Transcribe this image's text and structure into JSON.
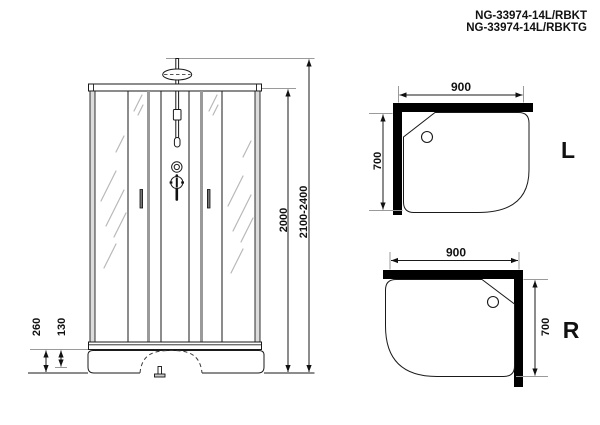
{
  "product_title": {
    "line1": "NG-33974-14L/RBKT",
    "line2": "NG-33974-14L/RBKTG"
  },
  "front_elevation": {
    "glass_height_mm": "2000",
    "total_height_mm": "2100-2400",
    "tray_height_mm": "260",
    "tray_step_mm": "130"
  },
  "plan_top": {
    "width_mm": "900",
    "depth_mm": "700",
    "orientation": "L"
  },
  "plan_bottom": {
    "width_mm": "900",
    "depth_mm": "700",
    "orientation": "R"
  },
  "colors": {
    "line": "#1a1a1a",
    "wall_black": "#000000",
    "extension_gray": "#9a9a9a",
    "glass_shine": "#b8b8b8",
    "frame_fill": "#dcdcdc",
    "door_overlap_fill": "#9a9a9a",
    "background": "#ffffff"
  }
}
